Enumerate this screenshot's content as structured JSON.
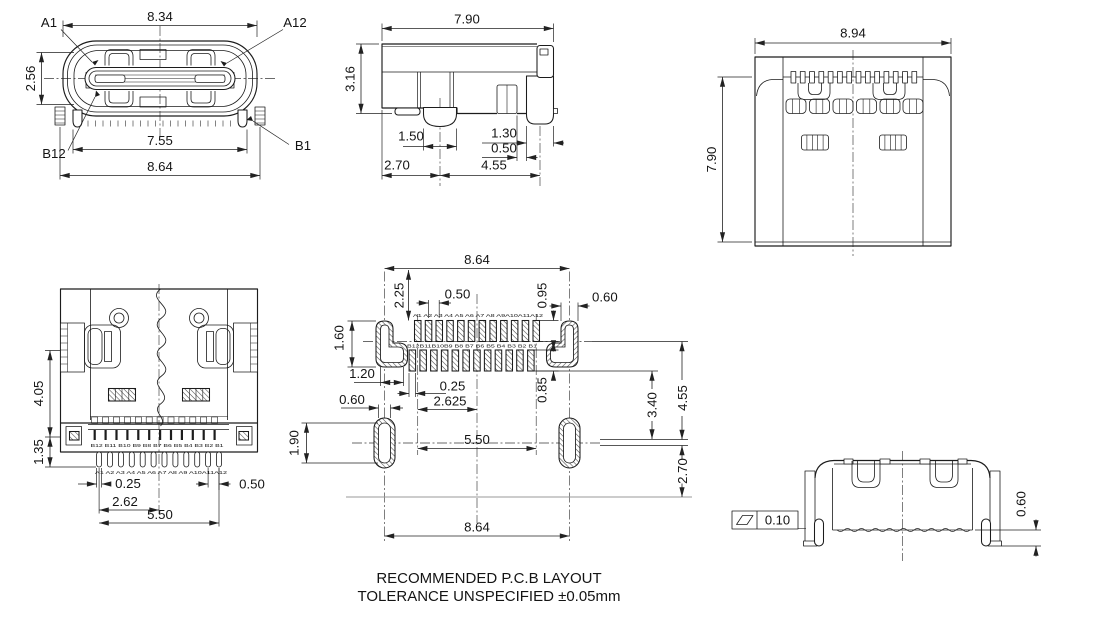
{
  "drawing_notes": {
    "line1": "RECOMMENDED P.C.B LAYOUT",
    "line2": "TOLERANCE UNSPECIFIED ±0.05mm"
  },
  "front_view": {
    "dim_shell_width": "8.34",
    "dim_shell_height": "2.56",
    "dim_lead_span": "7.55",
    "dim_overall_width": "8.64",
    "pin_a1": "A1",
    "pin_a12": "A12",
    "pin_b12": "B12",
    "pin_b1": "B1"
  },
  "side_view": {
    "dim_depth": "7.90",
    "dim_height": "3.16",
    "dim_post_width": "1.50",
    "dim_leg_width": "1.30",
    "dim_gap": "0.50",
    "dim_front_to_post": "2.70",
    "dim_post_to_leg": "4.55"
  },
  "top_view": {
    "dim_width": "8.94",
    "dim_depth": "7.90"
  },
  "bottom_view": {
    "dim_body_depth": "4.05",
    "dim_lead_depth": "1.35",
    "dim_pin_width": "0.25",
    "dim_half_span": "2.62",
    "dim_lead_span": "5.50",
    "dim_end_pitch": "0.50",
    "pin_labels_b": "B12 B11 B10 B9 B8 B7 B6 B5 B4 B3 B2 B1",
    "pin_labels_a": "A1 A2 A3 A4 A5 A6 A7 A8 A9 A10A11A12"
  },
  "pcb_layout": {
    "dim_shield_span_top": "8.64",
    "dim_edge_to_pads": "2.25",
    "dim_pad_pitch": "0.50",
    "dim_pad_length_a": "0.95",
    "dim_shield_pad_width": "0.60",
    "dim_shield_pad_height": "1.60",
    "dim_shield_hole_width": "1.20",
    "dim_pad_width": "0.25",
    "dim_row_offset": "2.625",
    "dim_pad_length_b": "0.85",
    "dim_3_40": "3.40",
    "dim_4_55": "4.55",
    "dim_2_70": "2.70",
    "dim_hole_width": "0.60",
    "dim_hole_height": "1.90",
    "dim_lead_span": "5.50",
    "dim_shield_span_bottom": "8.64",
    "pad_labels_a": "A1 A2 A3 A4 A5 A6 A7 A8 A9A10A11A12",
    "pad_labels_b": "B12B11B10B9 B8 B7 B6 B5 B4 B3 B2 B1"
  },
  "rear_view": {
    "flatness_tolerance": "0.10",
    "dim_standoff": "0.60"
  },
  "style": {
    "line_color": "#1c1c1c",
    "background": "#ffffff"
  }
}
